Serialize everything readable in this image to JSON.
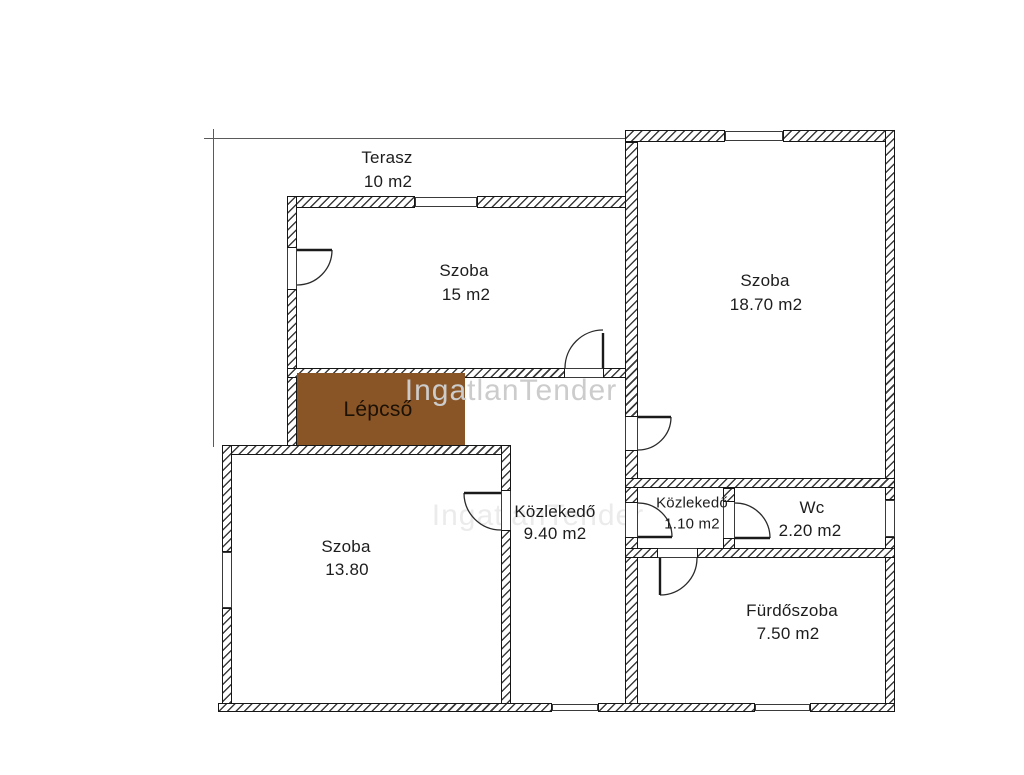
{
  "plan": {
    "watermark": "IngatlanTender",
    "colors": {
      "stairs_fill": "#8a5526",
      "wall_line": "#161616",
      "watermark": "#cccccc"
    },
    "rooms": {
      "terasz": {
        "name": "Terasz",
        "area": "10 m2"
      },
      "szoba15": {
        "name": "Szoba",
        "area": "15 m2"
      },
      "szoba1870": {
        "name": "Szoba",
        "area": "18.70 m2"
      },
      "lepcso": {
        "name": "Lépcső"
      },
      "szoba1380": {
        "name": "Szoba",
        "area": "13.80"
      },
      "kozlekedo940": {
        "name": "Közlekedő",
        "area": "9.40 m2"
      },
      "kozlekedo110": {
        "name": "Közlekedő",
        "area": "1.10 m2"
      },
      "wc": {
        "name": "Wc",
        "area": "2.20 m2"
      },
      "furdoszoba": {
        "name": "Fürdőszoba",
        "area": "7.50 m2"
      }
    }
  }
}
